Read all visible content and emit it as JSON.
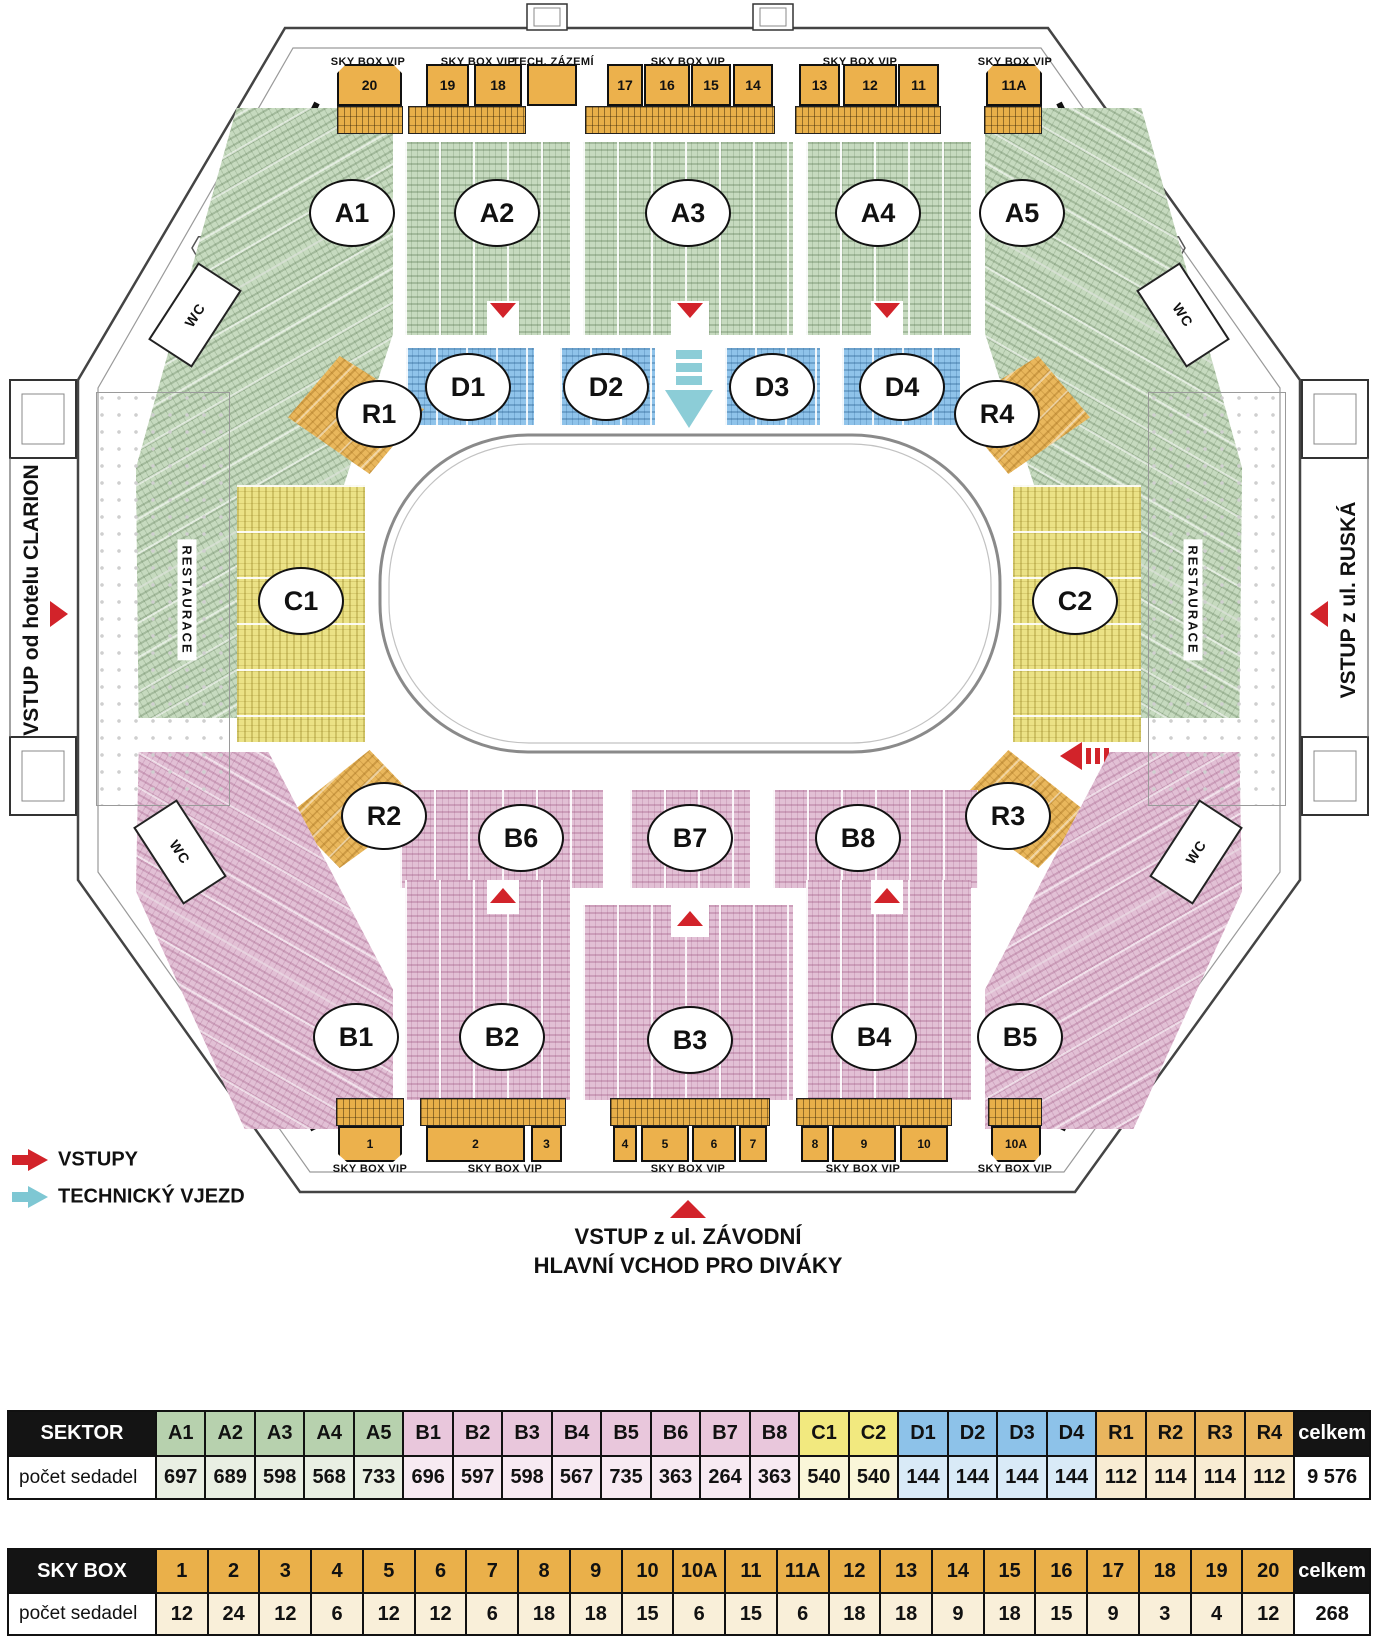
{
  "map": {
    "entrances": {
      "left": "VSTUP od hotelu CLARION",
      "right": "VSTUP z ul. RUSKÁ",
      "bottom_line1": "VSTUP z ul. ZÁVODNÍ",
      "bottom_line2": "HLAVNÍ VCHOD PRO DIVÁKY"
    },
    "legend": [
      {
        "label": "VSTUPY",
        "color": "#d2232a"
      },
      {
        "label": "TECHNICKÝ VJEZD",
        "color": "#7ec7d3"
      }
    ],
    "labels": {
      "skybox_vip": "SKY BOX VIP",
      "tech": "TECH. ZÁZEMÍ",
      "restaurace": "RESTAURACE",
      "wc": "WC"
    },
    "sectors": [
      {
        "id": "A1",
        "x": 352,
        "y": 213
      },
      {
        "id": "A2",
        "x": 497,
        "y": 213
      },
      {
        "id": "A3",
        "x": 688,
        "y": 213
      },
      {
        "id": "A4",
        "x": 878,
        "y": 213
      },
      {
        "id": "A5",
        "x": 1022,
        "y": 213
      },
      {
        "id": "R1",
        "x": 379,
        "y": 414
      },
      {
        "id": "D1",
        "x": 468,
        "y": 387
      },
      {
        "id": "D2",
        "x": 606,
        "y": 387
      },
      {
        "id": "D3",
        "x": 772,
        "y": 387
      },
      {
        "id": "D4",
        "x": 902,
        "y": 387
      },
      {
        "id": "R4",
        "x": 997,
        "y": 414
      },
      {
        "id": "C1",
        "x": 301,
        "y": 601
      },
      {
        "id": "C2",
        "x": 1075,
        "y": 601
      },
      {
        "id": "R2",
        "x": 384,
        "y": 816
      },
      {
        "id": "B6",
        "x": 521,
        "y": 838
      },
      {
        "id": "B7",
        "x": 690,
        "y": 838
      },
      {
        "id": "B8",
        "x": 858,
        "y": 838
      },
      {
        "id": "R3",
        "x": 1008,
        "y": 816
      },
      {
        "id": "B1",
        "x": 356,
        "y": 1037
      },
      {
        "id": "B2",
        "x": 502,
        "y": 1037
      },
      {
        "id": "B3",
        "x": 690,
        "y": 1040
      },
      {
        "id": "B4",
        "x": 874,
        "y": 1037
      },
      {
        "id": "B5",
        "x": 1020,
        "y": 1037
      }
    ],
    "skyboxes_top": [
      {
        "label": "20",
        "x": 337,
        "w": 65,
        "cut": "top"
      },
      {
        "label": "19",
        "x": 426,
        "w": 43
      },
      {
        "label": "18",
        "x": 474,
        "w": 48
      },
      {
        "label": "",
        "x": 527,
        "w": 50
      },
      {
        "label": "17",
        "x": 607,
        "w": 36
      },
      {
        "label": "16",
        "x": 644,
        "w": 46
      },
      {
        "label": "15",
        "x": 691,
        "w": 40
      },
      {
        "label": "14",
        "x": 733,
        "w": 40
      },
      {
        "label": "13",
        "x": 799,
        "w": 41
      },
      {
        "label": "12",
        "x": 843,
        "w": 54
      },
      {
        "label": "11",
        "x": 898,
        "w": 41
      },
      {
        "label": "11A",
        "x": 986,
        "w": 56,
        "cut": "top"
      }
    ],
    "skyboxes_bottom": [
      {
        "label": "1",
        "x": 338,
        "w": 64,
        "cut": "bottom"
      },
      {
        "label": "2",
        "x": 426,
        "w": 99
      },
      {
        "label": "3",
        "x": 531,
        "w": 31
      },
      {
        "label": "4",
        "x": 613,
        "w": 24
      },
      {
        "label": "5",
        "x": 641,
        "w": 48
      },
      {
        "label": "6",
        "x": 692,
        "w": 44
      },
      {
        "label": "7",
        "x": 739,
        "w": 28
      },
      {
        "label": "8",
        "x": 801,
        "w": 28
      },
      {
        "label": "9",
        "x": 832,
        "w": 64
      },
      {
        "label": "10",
        "x": 900,
        "w": 48
      },
      {
        "label": "10A",
        "x": 991,
        "w": 50,
        "cut": "bottom"
      }
    ],
    "skybox_vip_labels": {
      "top_y": 62,
      "top_x": [
        368,
        478,
        688,
        860,
        1015
      ],
      "bottom_y": 1169,
      "bottom_x": [
        370,
        505,
        688,
        863,
        1015
      ],
      "tech_x": 553
    },
    "vip_strips_top": [
      {
        "x": 337,
        "w": 66
      },
      {
        "x": 408,
        "w": 118
      },
      {
        "x": 585,
        "w": 190
      },
      {
        "x": 795,
        "w": 146
      },
      {
        "x": 984,
        "w": 58
      }
    ],
    "vip_strips_bottom": [
      {
        "x": 336,
        "w": 68
      },
      {
        "x": 420,
        "w": 146
      },
      {
        "x": 610,
        "w": 160
      },
      {
        "x": 796,
        "w": 156
      },
      {
        "x": 988,
        "w": 54
      }
    ]
  },
  "colors": {
    "A": {
      "h": "#b7d1ae",
      "v": "#e9efe3"
    },
    "B": {
      "h": "#e9c7dc",
      "v": "#f7eaf2"
    },
    "C": {
      "h": "#f2e97f",
      "v": "#faf6d9"
    },
    "D": {
      "h": "#8dc2e9",
      "v": "#d9eaf7"
    },
    "R": {
      "h": "#e9b55e",
      "v": "#f8ecd3"
    },
    "S": {
      "h": "#eab04a",
      "v": "#f9efd9"
    },
    "red": "#d2232a",
    "teal": "#7ec7d3"
  },
  "tables": {
    "sektor": {
      "row_header": "SEKTOR",
      "value_header": "počet sedadel",
      "total_label": "celkem",
      "total_value": "9 576",
      "columns": [
        {
          "label": "A1",
          "value": "697",
          "g": "A"
        },
        {
          "label": "A2",
          "value": "689",
          "g": "A"
        },
        {
          "label": "A3",
          "value": "598",
          "g": "A"
        },
        {
          "label": "A4",
          "value": "568",
          "g": "A"
        },
        {
          "label": "A5",
          "value": "733",
          "g": "A"
        },
        {
          "label": "B1",
          "value": "696",
          "g": "B"
        },
        {
          "label": "B2",
          "value": "597",
          "g": "B"
        },
        {
          "label": "B3",
          "value": "598",
          "g": "B"
        },
        {
          "label": "B4",
          "value": "567",
          "g": "B"
        },
        {
          "label": "B5",
          "value": "735",
          "g": "B"
        },
        {
          "label": "B6",
          "value": "363",
          "g": "B"
        },
        {
          "label": "B7",
          "value": "264",
          "g": "B"
        },
        {
          "label": "B8",
          "value": "363",
          "g": "B"
        },
        {
          "label": "C1",
          "value": "540",
          "g": "C"
        },
        {
          "label": "C2",
          "value": "540",
          "g": "C"
        },
        {
          "label": "D1",
          "value": "144",
          "g": "D"
        },
        {
          "label": "D2",
          "value": "144",
          "g": "D"
        },
        {
          "label": "D3",
          "value": "144",
          "g": "D"
        },
        {
          "label": "D4",
          "value": "144",
          "g": "D"
        },
        {
          "label": "R1",
          "value": "112",
          "g": "R"
        },
        {
          "label": "R2",
          "value": "114",
          "g": "R"
        },
        {
          "label": "R3",
          "value": "114",
          "g": "R"
        },
        {
          "label": "R4",
          "value": "112",
          "g": "R"
        }
      ]
    },
    "skybox": {
      "row_header": "SKY BOX",
      "value_header": "počet sedadel",
      "total_label": "celkem",
      "total_value": "268",
      "columns": [
        {
          "label": "1",
          "value": "12",
          "g": "S"
        },
        {
          "label": "2",
          "value": "24",
          "g": "S"
        },
        {
          "label": "3",
          "value": "12",
          "g": "S"
        },
        {
          "label": "4",
          "value": "6",
          "g": "S"
        },
        {
          "label": "5",
          "value": "12",
          "g": "S"
        },
        {
          "label": "6",
          "value": "12",
          "g": "S"
        },
        {
          "label": "7",
          "value": "6",
          "g": "S"
        },
        {
          "label": "8",
          "value": "18",
          "g": "S"
        },
        {
          "label": "9",
          "value": "18",
          "g": "S"
        },
        {
          "label": "10",
          "value": "15",
          "g": "S"
        },
        {
          "label": "10A",
          "value": "6",
          "g": "S"
        },
        {
          "label": "11",
          "value": "15",
          "g": "S"
        },
        {
          "label": "11A",
          "value": "6",
          "g": "S"
        },
        {
          "label": "12",
          "value": "18",
          "g": "S"
        },
        {
          "label": "13",
          "value": "18",
          "g": "S"
        },
        {
          "label": "14",
          "value": "9",
          "g": "S"
        },
        {
          "label": "15",
          "value": "18",
          "g": "S"
        },
        {
          "label": "16",
          "value": "15",
          "g": "S"
        },
        {
          "label": "17",
          "value": "9",
          "g": "S"
        },
        {
          "label": "18",
          "value": "3",
          "g": "S"
        },
        {
          "label": "19",
          "value": "4",
          "g": "S"
        },
        {
          "label": "20",
          "value": "12",
          "g": "S"
        }
      ]
    }
  }
}
